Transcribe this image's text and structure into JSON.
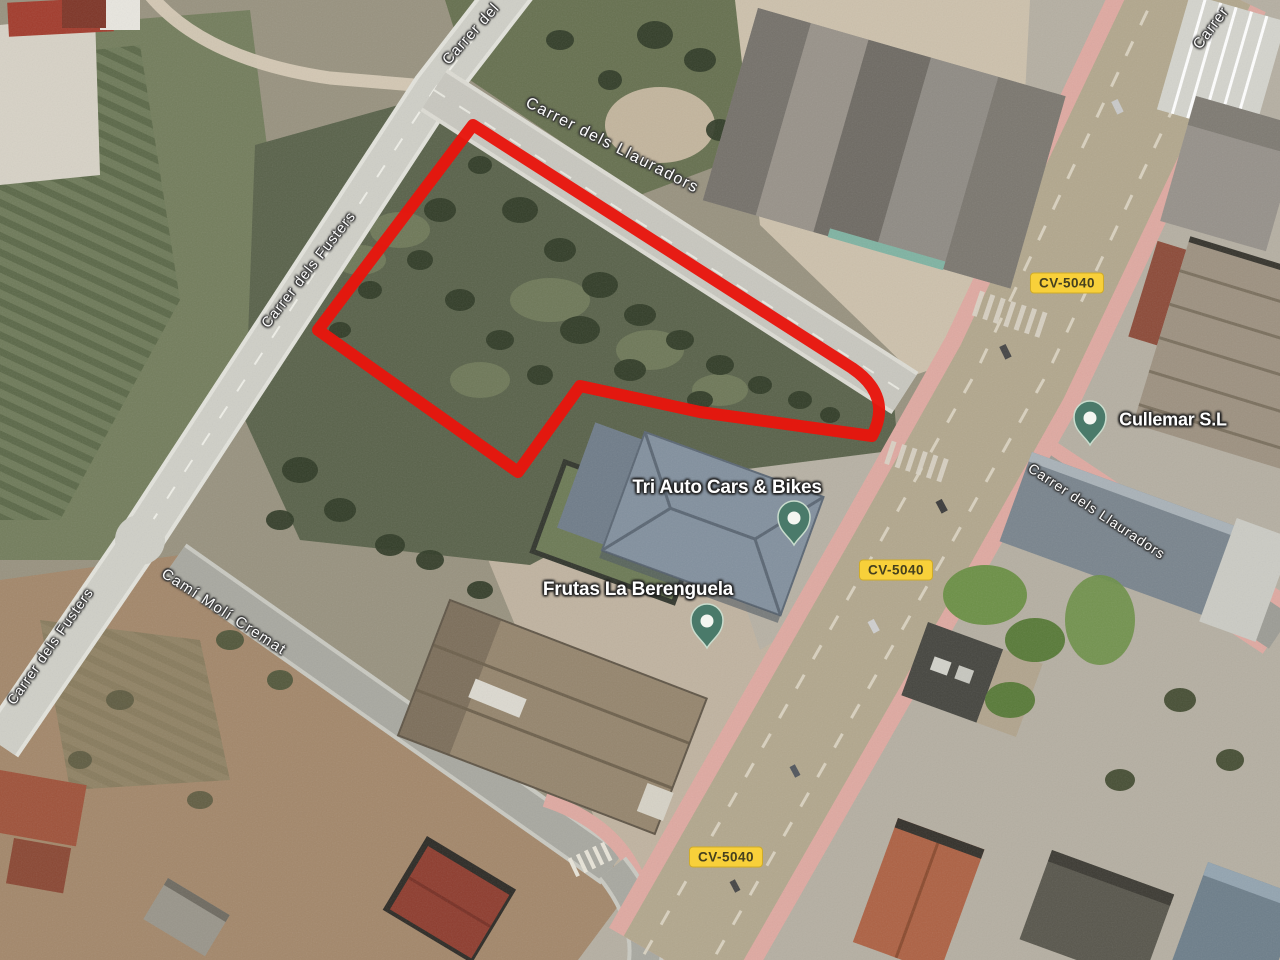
{
  "map_type": "satellite",
  "colors": {
    "parcel_outline": "#e8150d",
    "badge_bg": "#f8d03a",
    "badge_text": "#45401e",
    "pin_fill": "#4a7a6a",
    "pin_ring": "#c9dccd",
    "pin_dot": "#f4f6f1"
  },
  "parcel": {
    "path": "M 473 125 L 852 368 Q 893 396 872 436 L 700 412 L 580 386 L 518 472 L 318 330 Z"
  },
  "road_labels": [
    {
      "text": "Carrer del"
    },
    {
      "text": "Carrer dels Llauradors"
    },
    {
      "text": "Carrer dels Fusters"
    },
    {
      "text": "Carrer dels Fusters"
    },
    {
      "text": "Camí Molí Cremat"
    },
    {
      "text": "Carrer dels Llauradors"
    },
    {
      "text": "Carrer"
    }
  ],
  "road_badges": [
    {
      "text": "CV-5040"
    },
    {
      "text": "CV-5040"
    },
    {
      "text": "CV-5040"
    }
  ],
  "places": [
    {
      "name": "Tri Auto Cars & Bikes"
    },
    {
      "name": "Frutas La Berenguela"
    },
    {
      "name": "Cullemar S.L"
    }
  ]
}
